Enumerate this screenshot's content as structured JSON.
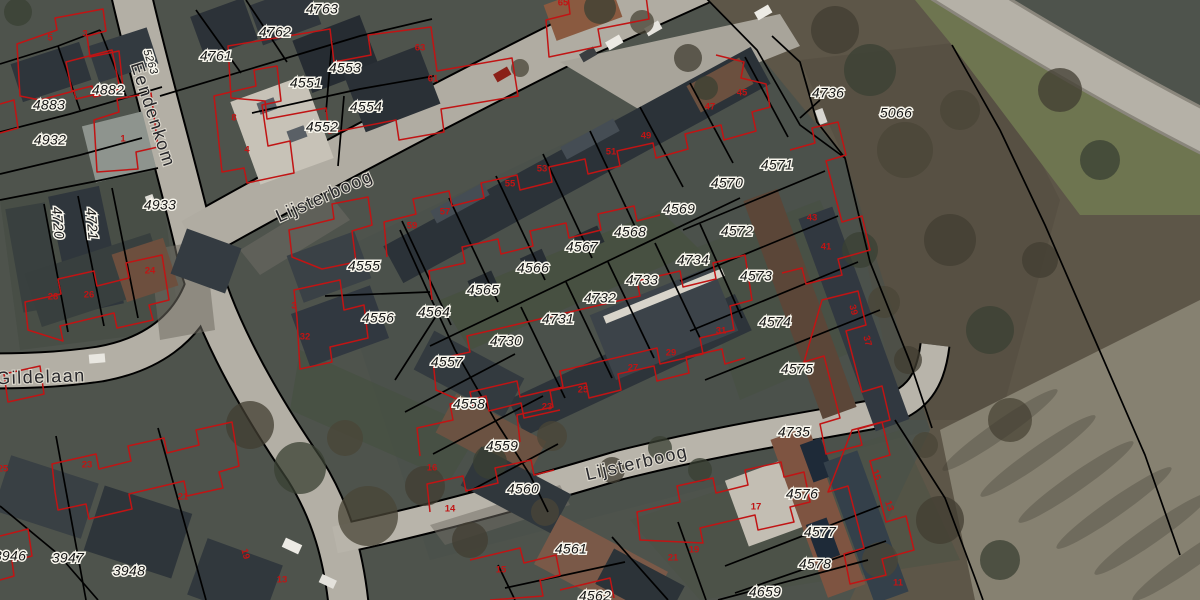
{
  "map": {
    "type": "cadastral-aerial-viewer",
    "overlay_colors": {
      "parcel_line": "#000000",
      "building_outline": "#c11414",
      "parcel_text": "#161616",
      "halo": "#f7f5ec"
    },
    "streets": [
      {
        "text": "Eendenkom",
        "x": 152,
        "y": 115,
        "rot": 72
      },
      {
        "text": "Lijsterboog",
        "x": 325,
        "y": 197,
        "rot": -24
      },
      {
        "text": "Lijsterboog",
        "x": 637,
        "y": 464,
        "rot": -13
      },
      {
        "text": "Gildelaan",
        "x": 41,
        "y": 378,
        "rot": -2
      }
    ],
    "parcels": [
      {
        "text": "5263",
        "x": 150,
        "y": 62,
        "rot": 72,
        "cls": "small"
      },
      {
        "text": "4763",
        "x": 322,
        "y": 10
      },
      {
        "text": "4762",
        "x": 275,
        "y": 33
      },
      {
        "text": "4761",
        "x": 216,
        "y": 57
      },
      {
        "text": "4883",
        "x": 49,
        "y": 106
      },
      {
        "text": "4882",
        "x": 108,
        "y": 91
      },
      {
        "text": "4932",
        "x": 50,
        "y": 141
      },
      {
        "text": "4933",
        "x": 160,
        "y": 206
      },
      {
        "text": "4720",
        "x": 57,
        "y": 223,
        "rot": 85
      },
      {
        "text": "4721",
        "x": 91,
        "y": 224,
        "rot": 85
      },
      {
        "text": "4551",
        "x": 306,
        "y": 84
      },
      {
        "text": "4553",
        "x": 345,
        "y": 69
      },
      {
        "text": "4554",
        "x": 366,
        "y": 108
      },
      {
        "text": "4552",
        "x": 322,
        "y": 128
      },
      {
        "text": "4555",
        "x": 364,
        "y": 267
      },
      {
        "text": "4556",
        "x": 378,
        "y": 319
      },
      {
        "text": "4557",
        "x": 447,
        "y": 363
      },
      {
        "text": "4558",
        "x": 469,
        "y": 405
      },
      {
        "text": "4559",
        "x": 502,
        "y": 447
      },
      {
        "text": "4560",
        "x": 523,
        "y": 490
      },
      {
        "text": "4561",
        "x": 571,
        "y": 550
      },
      {
        "text": "4562",
        "x": 595,
        "y": 597
      },
      {
        "text": "4564",
        "x": 434,
        "y": 313
      },
      {
        "text": "4565",
        "x": 483,
        "y": 291
      },
      {
        "text": "4566",
        "x": 533,
        "y": 269
      },
      {
        "text": "4567",
        "x": 582,
        "y": 248
      },
      {
        "text": "4568",
        "x": 630,
        "y": 233
      },
      {
        "text": "4569",
        "x": 679,
        "y": 210
      },
      {
        "text": "4570",
        "x": 727,
        "y": 184
      },
      {
        "text": "4571",
        "x": 777,
        "y": 166
      },
      {
        "text": "4572",
        "x": 737,
        "y": 232
      },
      {
        "text": "4573",
        "x": 756,
        "y": 277
      },
      {
        "text": "4574",
        "x": 775,
        "y": 323
      },
      {
        "text": "4575",
        "x": 797,
        "y": 370
      },
      {
        "text": "4730",
        "x": 506,
        "y": 342
      },
      {
        "text": "4731",
        "x": 558,
        "y": 320
      },
      {
        "text": "4732",
        "x": 600,
        "y": 299
      },
      {
        "text": "4733",
        "x": 642,
        "y": 281
      },
      {
        "text": "4734",
        "x": 693,
        "y": 261
      },
      {
        "text": "4735",
        "x": 794,
        "y": 433
      },
      {
        "text": "4736",
        "x": 828,
        "y": 94
      },
      {
        "text": "5066",
        "x": 896,
        "y": 114
      },
      {
        "text": "4576",
        "x": 802,
        "y": 495
      },
      {
        "text": "4577",
        "x": 820,
        "y": 533
      },
      {
        "text": "4578",
        "x": 815,
        "y": 565
      },
      {
        "text": "4659",
        "x": 765,
        "y": 593
      },
      {
        "text": "3946",
        "x": 10,
        "y": 557
      },
      {
        "text": "3947",
        "x": 68,
        "y": 559
      },
      {
        "text": "3948",
        "x": 129,
        "y": 572
      }
    ],
    "house_numbers": [
      {
        "text": "5",
        "x": 50,
        "y": 38
      },
      {
        "text": "3",
        "x": 85,
        "y": 34
      },
      {
        "text": "1",
        "x": 123,
        "y": 139
      },
      {
        "text": "8",
        "x": 234,
        "y": 118
      },
      {
        "text": "4",
        "x": 247,
        "y": 150
      },
      {
        "text": "63",
        "x": 420,
        "y": 48
      },
      {
        "text": "61",
        "x": 433,
        "y": 79
      },
      {
        "text": "65",
        "x": 563,
        "y": 3
      },
      {
        "text": "59",
        "x": 412,
        "y": 226
      },
      {
        "text": "57",
        "x": 445,
        "y": 212
      },
      {
        "text": "55",
        "x": 510,
        "y": 184
      },
      {
        "text": "53",
        "x": 542,
        "y": 169
      },
      {
        "text": "51",
        "x": 611,
        "y": 152
      },
      {
        "text": "49",
        "x": 646,
        "y": 136
      },
      {
        "text": "47",
        "x": 710,
        "y": 107
      },
      {
        "text": "45",
        "x": 742,
        "y": 93
      },
      {
        "text": "43",
        "x": 812,
        "y": 218
      },
      {
        "text": "41",
        "x": 826,
        "y": 247
      },
      {
        "text": "39",
        "x": 853,
        "y": 310,
        "rot": 75
      },
      {
        "text": "37",
        "x": 867,
        "y": 341,
        "rot": 75
      },
      {
        "text": "31",
        "x": 721,
        "y": 331
      },
      {
        "text": "29",
        "x": 671,
        "y": 353
      },
      {
        "text": "27",
        "x": 633,
        "y": 368
      },
      {
        "text": "25",
        "x": 583,
        "y": 390
      },
      {
        "text": "23",
        "x": 547,
        "y": 407
      },
      {
        "text": "24",
        "x": 150,
        "y": 271
      },
      {
        "text": "26",
        "x": 89,
        "y": 295
      },
      {
        "text": "28",
        "x": 53,
        "y": 297
      },
      {
        "text": "16",
        "x": 432,
        "y": 468
      },
      {
        "text": "14",
        "x": 450,
        "y": 509
      },
      {
        "text": "15",
        "x": 501,
        "y": 570
      },
      {
        "text": "21",
        "x": 673,
        "y": 558
      },
      {
        "text": "19",
        "x": 694,
        "y": 550
      },
      {
        "text": "17",
        "x": 756,
        "y": 507
      },
      {
        "text": "15",
        "x": 876,
        "y": 475,
        "rot": 70
      },
      {
        "text": "13",
        "x": 889,
        "y": 506,
        "rot": 70
      },
      {
        "text": "11",
        "x": 898,
        "y": 583
      },
      {
        "text": "23",
        "x": 87,
        "y": 465
      },
      {
        "text": "21",
        "x": 183,
        "y": 497
      },
      {
        "text": "19",
        "x": 245,
        "y": 554,
        "rot": 75
      },
      {
        "text": "25",
        "x": 3,
        "y": 469
      },
      {
        "text": "3",
        "x": 294,
        "y": 306
      },
      {
        "text": "32",
        "x": 305,
        "y": 337
      },
      {
        "text": "13",
        "x": 282,
        "y": 580
      }
    ]
  }
}
